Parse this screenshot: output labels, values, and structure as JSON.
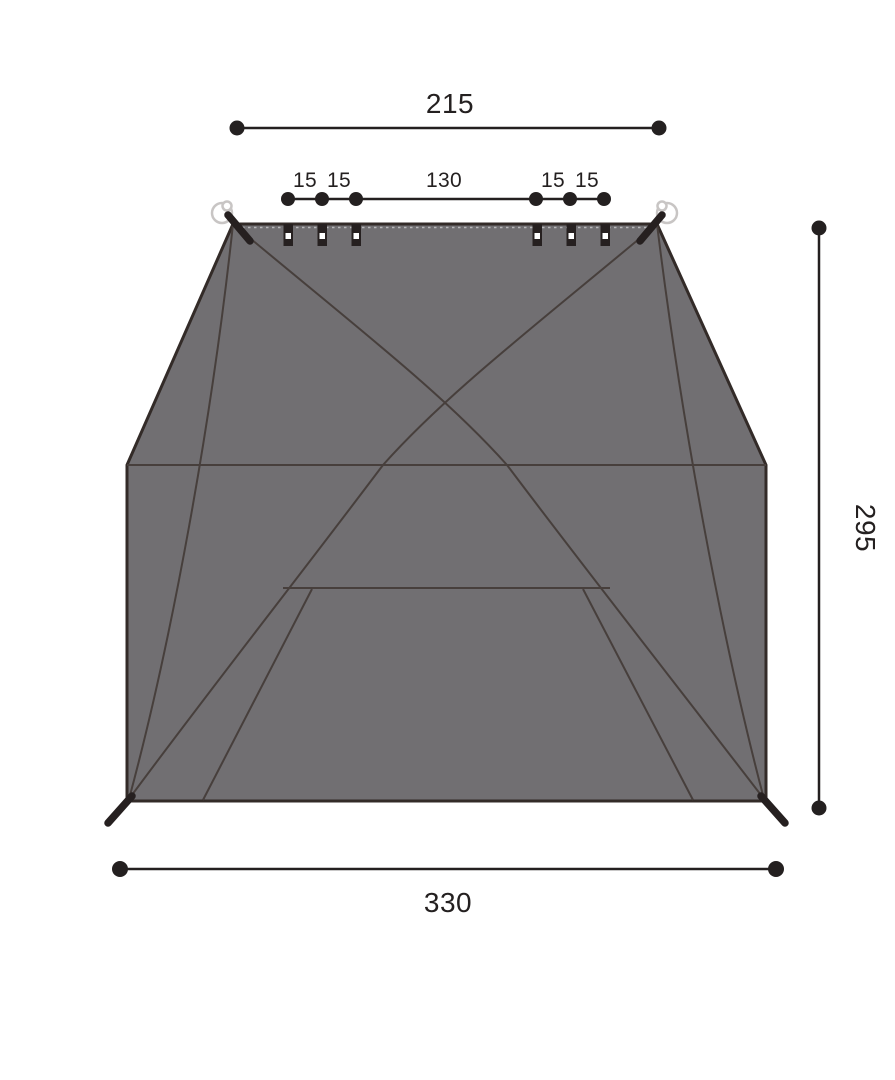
{
  "figure": {
    "type": "tent-dimension-diagram",
    "labels": {
      "ridge_width": "215",
      "segments": [
        "15",
        "15",
        "130",
        "15",
        "15"
      ],
      "side_height": "295",
      "base_width": "330"
    },
    "colors": {
      "background": "#FFFFFF",
      "tent_fill": "#716F72",
      "tent_outline": "#332B28",
      "seam_line": "#473F3C",
      "dimension": "#242020",
      "hardware": "#262020",
      "ring_stroke": "#C8C5C4",
      "tab_hole": "#FFFFFF"
    }
  }
}
